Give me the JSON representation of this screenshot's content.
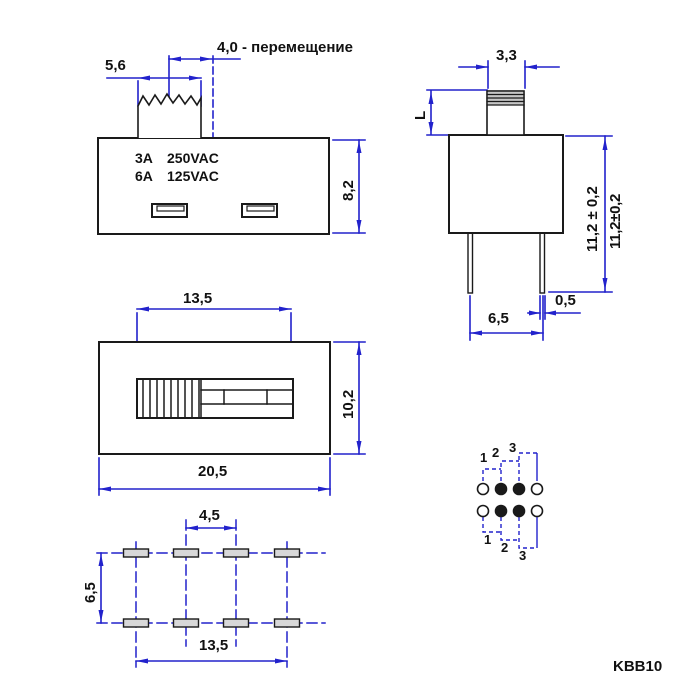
{
  "drawing": {
    "part_number": "KBB10",
    "front_view": {
      "travel_label": "4,0 - перемещение",
      "knob_width": "5,6",
      "body_height": "8,2",
      "rating_row1": {
        "current": "3A",
        "voltage": "250VAC"
      },
      "rating_row2": {
        "current": "6A",
        "voltage": "125VAC"
      }
    },
    "side_view": {
      "knob_width": "3,3",
      "knob_height_label": "L",
      "overall_height": "11,2 ± 0,2",
      "overall_height_note": "11,2±0,2",
      "pin_width": "0,5",
      "pin_spacing": "6,5"
    },
    "top_view": {
      "slot_length": "13,5",
      "body_width": "10,2",
      "body_length": "20,5"
    },
    "hole_pattern": {
      "pin_pitch": "4,5",
      "row_spacing": "6,5",
      "pin_span": "13,5"
    },
    "position_diagram": {
      "top_labels": [
        "1",
        "2",
        "3"
      ],
      "bottom_labels": [
        "1",
        "2",
        "3"
      ]
    },
    "colors": {
      "dimension_blue": "#2222cc",
      "outline_black": "#1a1a1a"
    }
  }
}
